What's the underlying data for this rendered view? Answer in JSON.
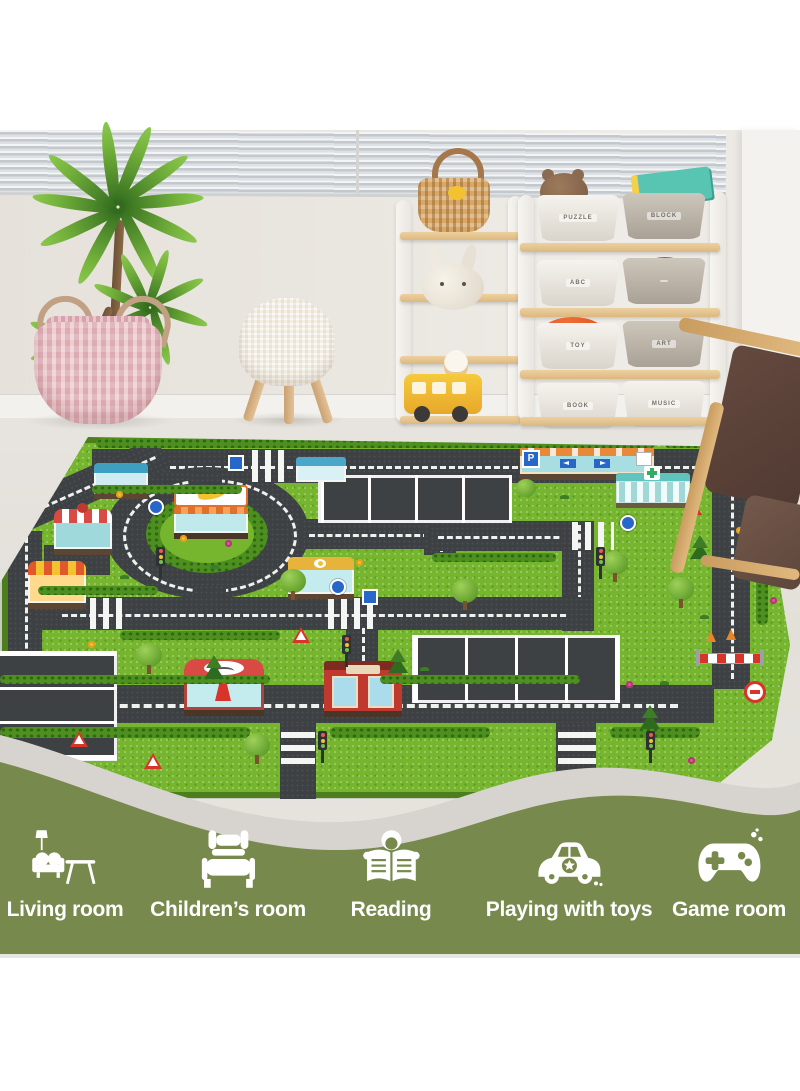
{
  "banner": {
    "background_color": "#77894c",
    "wave_color": "#d7d3cf",
    "text_color": "#ffffff",
    "items": [
      {
        "icon": "sofa-lamp-table-icon",
        "label": "Living room"
      },
      {
        "icon": "bed-icon",
        "label": "Children’s room"
      },
      {
        "icon": "person-reading-icon",
        "label": "Reading"
      },
      {
        "icon": "toy-car-star-icon",
        "label": "Playing with toys"
      },
      {
        "icon": "gamepad-icon",
        "label": "Game room"
      }
    ]
  },
  "room": {
    "toy_shelf": {
      "bins": [
        {
          "label": "PUZZLE"
        },
        {
          "label": "BLOCK"
        },
        {
          "label": "ABC"
        },
        {
          "label": ""
        },
        {
          "label": "TOY"
        },
        {
          "label": "ART"
        },
        {
          "label": "BOOK"
        },
        {
          "label": "MUSIC"
        }
      ]
    }
  },
  "rug": {
    "grass_color": "#76b52e",
    "road_color": "#3d4144",
    "border_color": "#4d7e1e",
    "parking_sign": "P"
  }
}
